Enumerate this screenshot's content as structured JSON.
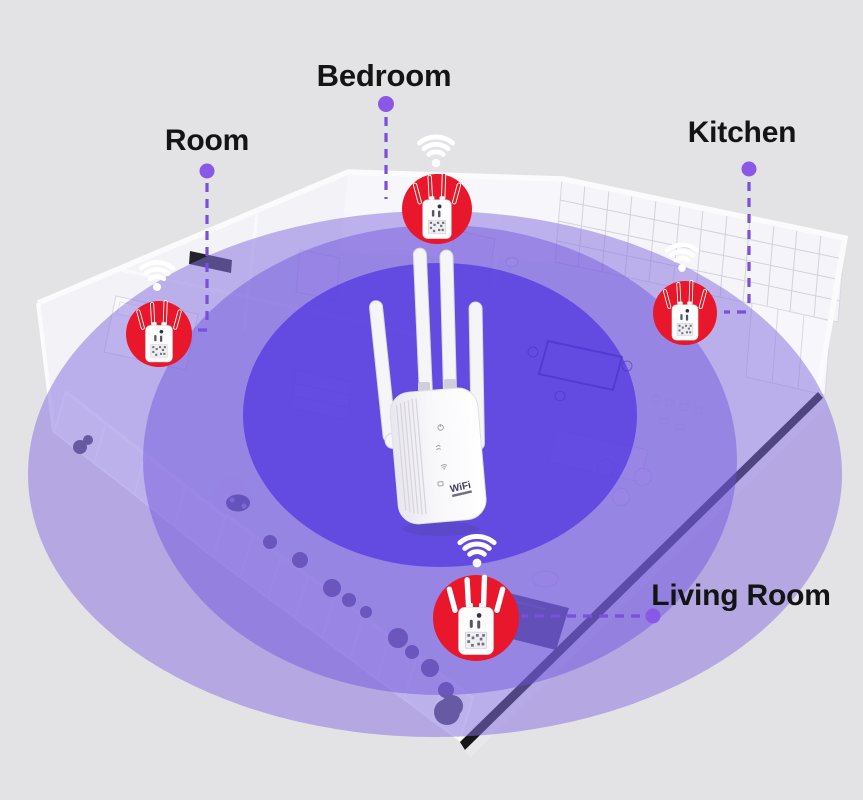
{
  "illustration": {
    "type": "wifi-repeater-coverage-floorplan",
    "description_visible_text_only": true
  },
  "labels": {
    "room": "Room",
    "bedroom": "Bedroom",
    "kitchen": "Kitchen",
    "living_room": "Living Room"
  },
  "device": {
    "kind": "wifi-repeater",
    "logo_text": "WiFi",
    "antennas": 4,
    "indicator_icons": [
      "power-icon",
      "signal-waves-icon",
      "wifi-icon",
      "ethernet-icon"
    ]
  },
  "markers": [
    {
      "location": "bedroom",
      "icon": "wifi-extender-marker-icon",
      "circle_color": "#e8172b",
      "antenna_color": "#d6202e"
    },
    {
      "location": "room",
      "icon": "wifi-extender-marker-icon",
      "circle_color": "#e8172b",
      "antenna_color": "#d6202e"
    },
    {
      "location": "kitchen",
      "icon": "wifi-extender-marker-icon",
      "circle_color": "#e8172b",
      "antenna_color": "#d6202e"
    },
    {
      "location": "living_room",
      "icon": "wifi-extender-marker-icon",
      "circle_color": "#e8172b",
      "antenna_color": "#ffffff"
    }
  ],
  "wifi_signal_icon": {
    "name": "wifi-signal-icon",
    "color": "#ffffff",
    "count": 4
  },
  "coverage_rings": {
    "count": 3,
    "outer_color": "rgba(136,114,224,0.52)",
    "middle_color": "rgba(108,82,220,0.45)",
    "inner_color": "rgba(68,40,225,0.62)"
  },
  "callouts": {
    "style": "dashed",
    "line_color": "#7a4ede",
    "dot_color": "#8a58e6"
  },
  "colors": {
    "background": "#e3e2e4",
    "marker_red": "#e8172b",
    "label_text": "#141414",
    "floor_slab": "#f3f2f6",
    "slab_edge": "#15151a"
  }
}
